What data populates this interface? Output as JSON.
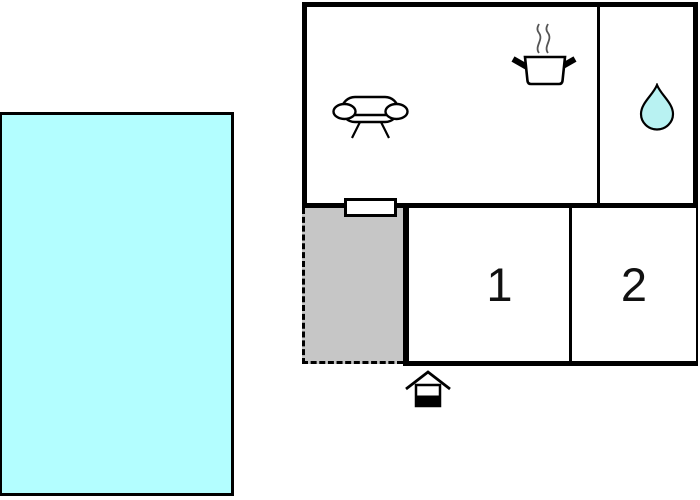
{
  "rooms": {
    "room1": {
      "label": "1"
    },
    "room2": {
      "label": "2"
    }
  },
  "icons": {
    "sofa": "sofa-icon",
    "cooking_pot": "cooking-pot-icon",
    "water_drop": "water-drop-icon",
    "entrance": "entrance-house-icon"
  },
  "colors": {
    "pool": "#b3feff",
    "terrace": "#c6c6c6",
    "drop_fill": "#b8f2f2",
    "wall": "#000000"
  }
}
